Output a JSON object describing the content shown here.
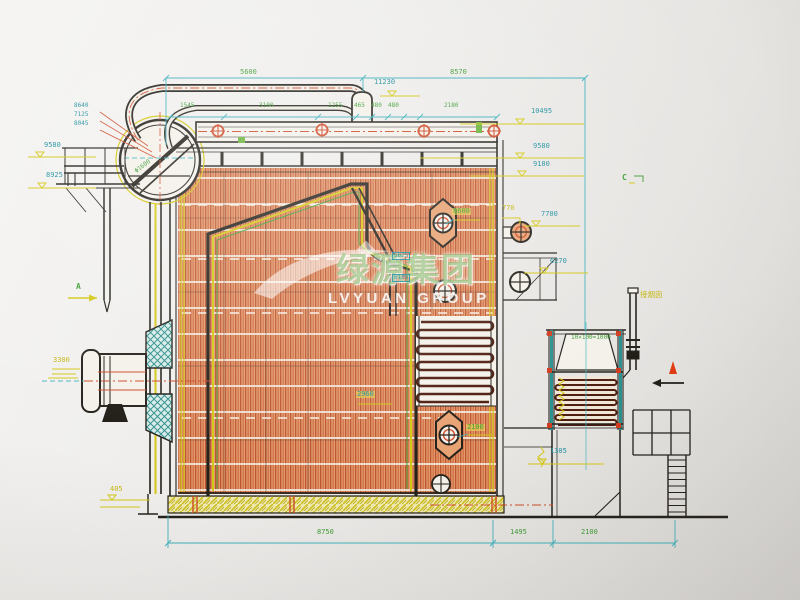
{
  "watermark": {
    "cn": "绿源集团",
    "en": "LVYUAN GROUP"
  },
  "markers": {
    "a": "A",
    "c": "C"
  },
  "dims": {
    "d5600": "5600",
    "d8570": "8570",
    "row": [
      "1545",
      "3100",
      "1255",
      "465",
      "480",
      "480",
      "2180"
    ],
    "bottom": [
      "8750",
      "1495",
      "2100"
    ]
  },
  "levels": {
    "l11230": "11230",
    "right": [
      "10495",
      "9580",
      "9180",
      "7700",
      "6270"
    ],
    "left": [
      "9580",
      "8925"
    ],
    "burner": "3300",
    "base": "405",
    "duct": "1305",
    "nozzle": "770"
  },
  "callouts": {
    "manhole_upper": "8600",
    "manhole_lower": "2100",
    "rear_width": "2960",
    "eco_pitch": "10×100=1000",
    "drum_spec": "Φ1600",
    "tags": [
      "5625",
      "6105"
    ],
    "stack": [
      "8640",
      "7125",
      "8045"
    ],
    "chimney": "接烟囱"
  }
}
